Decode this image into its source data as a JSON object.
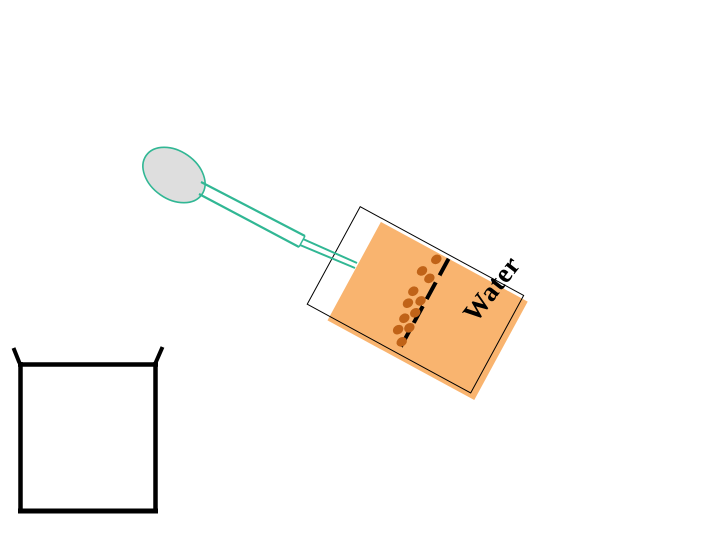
{
  "labels": {
    "water": "Water"
  },
  "colors": {
    "background": "#ffffff",
    "outline": "#000000",
    "water_fill": "#f9b46f",
    "particle": "#c06318",
    "dropper": "#31b794",
    "bulb_fill": "#dedede"
  },
  "diagram": {
    "bulb": {
      "cx": 174,
      "cy": 175,
      "rx": 34,
      "ry": 24,
      "rotation_deg": 35
    },
    "dropper_lines": [
      {
        "x1": 201,
        "y1": 182,
        "x2": 305,
        "y2": 236,
        "w": 2.2
      },
      {
        "x1": 199,
        "y1": 194,
        "x2": 299,
        "y2": 247,
        "w": 2.2
      },
      {
        "x1": 305,
        "y1": 236,
        "x2": 299,
        "y2": 247,
        "w": 1.4
      },
      {
        "x1": 303,
        "y1": 239,
        "x2": 357,
        "y2": 263,
        "w": 2
      },
      {
        "x1": 300,
        "y1": 245,
        "x2": 355,
        "y2": 268,
        "w": 2
      }
    ],
    "test_tube": {
      "x": 360,
      "y": 206,
      "width": 187,
      "height": 112,
      "rotation_deg": 28.5,
      "air_gap_px": 26,
      "water_offset": {
        "top": 4,
        "right_overhang": 6,
        "bottom_overhang": 4
      },
      "dashed_line": {
        "x": 101,
        "y": 4,
        "length": 106,
        "thickness": 4,
        "dash": 19,
        "gap": 8
      }
    },
    "particles": [
      {
        "x": 92,
        "y": 10
      },
      {
        "x": 85,
        "y": 27
      },
      {
        "x": 95,
        "y": 30
      },
      {
        "x": 87,
        "y": 49
      },
      {
        "x": 98,
        "y": 54
      },
      {
        "x": 88,
        "y": 62
      },
      {
        "x": 99,
        "y": 67
      },
      {
        "x": 92,
        "y": 77
      },
      {
        "x": 101,
        "y": 83
      },
      {
        "x": 92,
        "y": 90
      },
      {
        "x": 101,
        "y": 99
      }
    ],
    "water_label_pos": {
      "x": 492,
      "y": 289,
      "rotation_deg": -52,
      "font_size": 27
    },
    "beaker_segments": [
      {
        "x1": 20.5,
        "y1": 362,
        "x2": 20.5,
        "y2": 513,
        "w": 4.5
      },
      {
        "x1": 18,
        "y1": 511,
        "x2": 158,
        "y2": 511,
        "w": 5
      },
      {
        "x1": 155.5,
        "y1": 362,
        "x2": 155.5,
        "y2": 513,
        "w": 4.5
      },
      {
        "x1": 18,
        "y1": 364.5,
        "x2": 158,
        "y2": 364.5,
        "w": 4.5
      },
      {
        "x1": 19.5,
        "y1": 363,
        "x2": 13.5,
        "y2": 348,
        "w": 4
      },
      {
        "x1": 155.5,
        "y1": 363,
        "x2": 162.5,
        "y2": 347,
        "w": 4
      }
    ]
  }
}
